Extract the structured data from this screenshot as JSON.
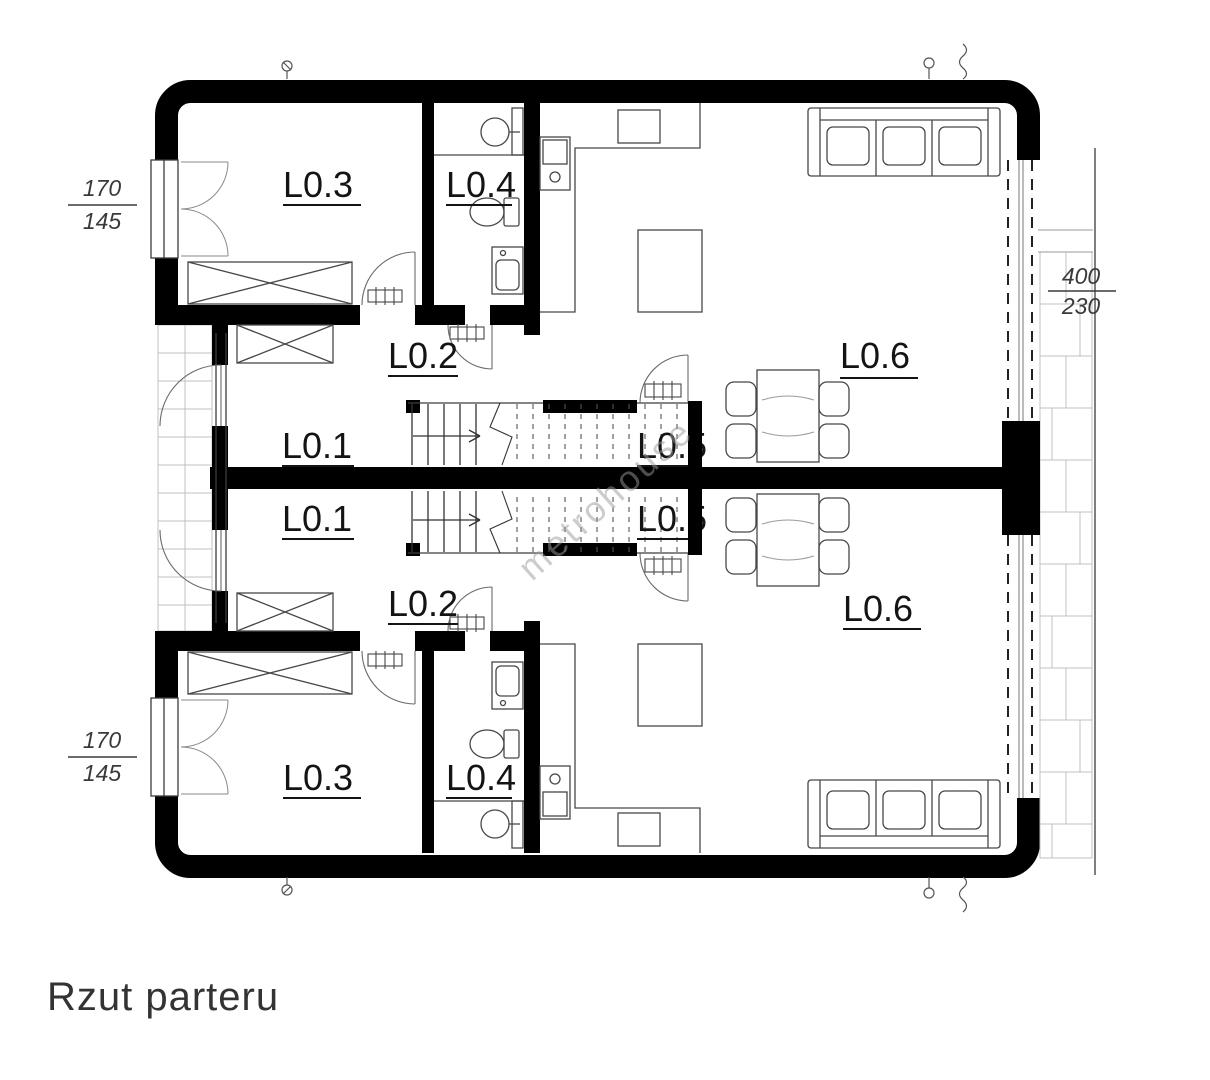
{
  "title": "Rzut parteru",
  "watermark": "metrohouse",
  "rooms": {
    "upper": {
      "l01": "L0.1",
      "l02": "L0.2",
      "l03": "L0.3",
      "l04": "L0.4",
      "l05": "L0.5",
      "l06": "L0.6"
    },
    "lower": {
      "l01": "L0.1",
      "l02": "L0.2",
      "l03": "L0.3",
      "l04": "L0.4",
      "l05": "L0.5",
      "l06": "L0.6"
    }
  },
  "dimensions": {
    "left_top": {
      "width": "170",
      "height": "145"
    },
    "left_bottom": {
      "width": "170",
      "height": "145"
    },
    "right": {
      "width": "400",
      "height": "230"
    }
  },
  "colors": {
    "wall": "#000000",
    "line": "#3c3c3c",
    "furniture": "#474747",
    "tile": "#c0c0c0",
    "label": "#141414",
    "watermark": "#9a9a9a"
  }
}
